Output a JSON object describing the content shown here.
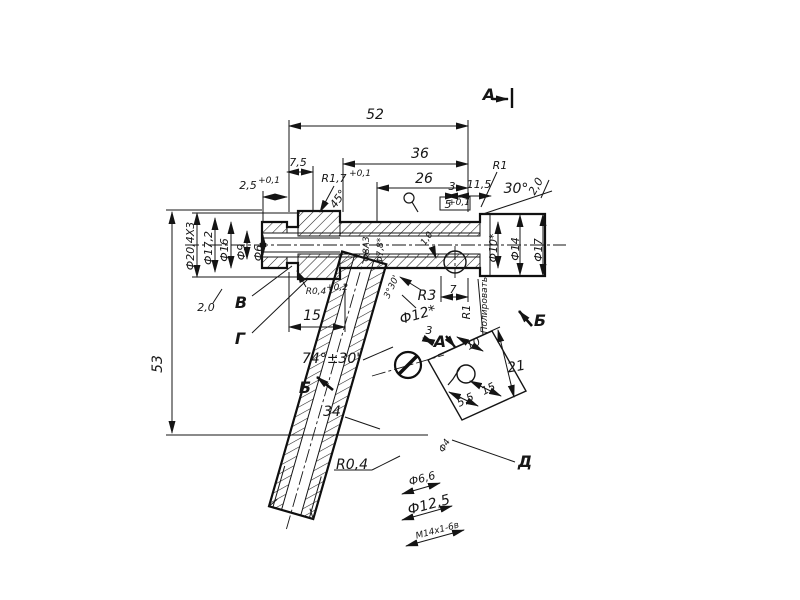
{
  "drawing": {
    "colors": {
      "ink": "#161616",
      "paper": "#ffffff"
    },
    "section_markers": {
      "a_top": "А",
      "a_detail": "А",
      "b_main": "Б",
      "b_side": "Б"
    },
    "view_labels": {
      "v": "В",
      "g": "Г",
      "d": "Д"
    },
    "top_dims": {
      "d52": "52",
      "d36": "36",
      "d26": "26",
      "d7_5": "7,5",
      "d2_5": "2,5",
      "d2_5_tol": "+0,1",
      "r1_7": "R1,7",
      "r1_7_tol": "+0,1",
      "chamfer45": "45°",
      "d3": "3",
      "d11_5": "11,5",
      "d5": "5",
      "d5_tol": "+0,1",
      "r1": "R1",
      "angle30": "30°",
      "ch2_right": "2,0"
    },
    "left_dims": {
      "f20_4": "Ф20,4Х3",
      "f17_2": "Ф17,2",
      "f16": "Ф16",
      "f9": "Ф9",
      "f6": "Ф6",
      "ch2_left": "2,0",
      "d15": "15",
      "d53": "53",
      "r0_4_groove": "R0,4",
      "r0_4_groove_tol": "+0,2"
    },
    "right_dims": {
      "f10": "Ф10*",
      "f14": "Ф14",
      "f17": "Ф17",
      "polish_note": "Полировать",
      "r1_side": "R1",
      "d7": "7"
    },
    "middle_dims": {
      "f8a3": "Ф8А3",
      "f7_8": "Ф7,8*",
      "c1_0": "1,0",
      "r3": "R3",
      "f12": "Ф12*",
      "a3_30": "3°30'",
      "a74": "74°±30'",
      "d34": "34"
    },
    "detail_dims": {
      "d3": "3",
      "d10": "10",
      "d21": "21",
      "d15": "15",
      "d5_5": "5,5"
    },
    "bottom_dims": {
      "r0_4": "R0,4",
      "f4": "Ф4",
      "f6_6": "Ф6,6",
      "f12_5": "Ф12,5",
      "thread": "М14х1-6в"
    }
  }
}
